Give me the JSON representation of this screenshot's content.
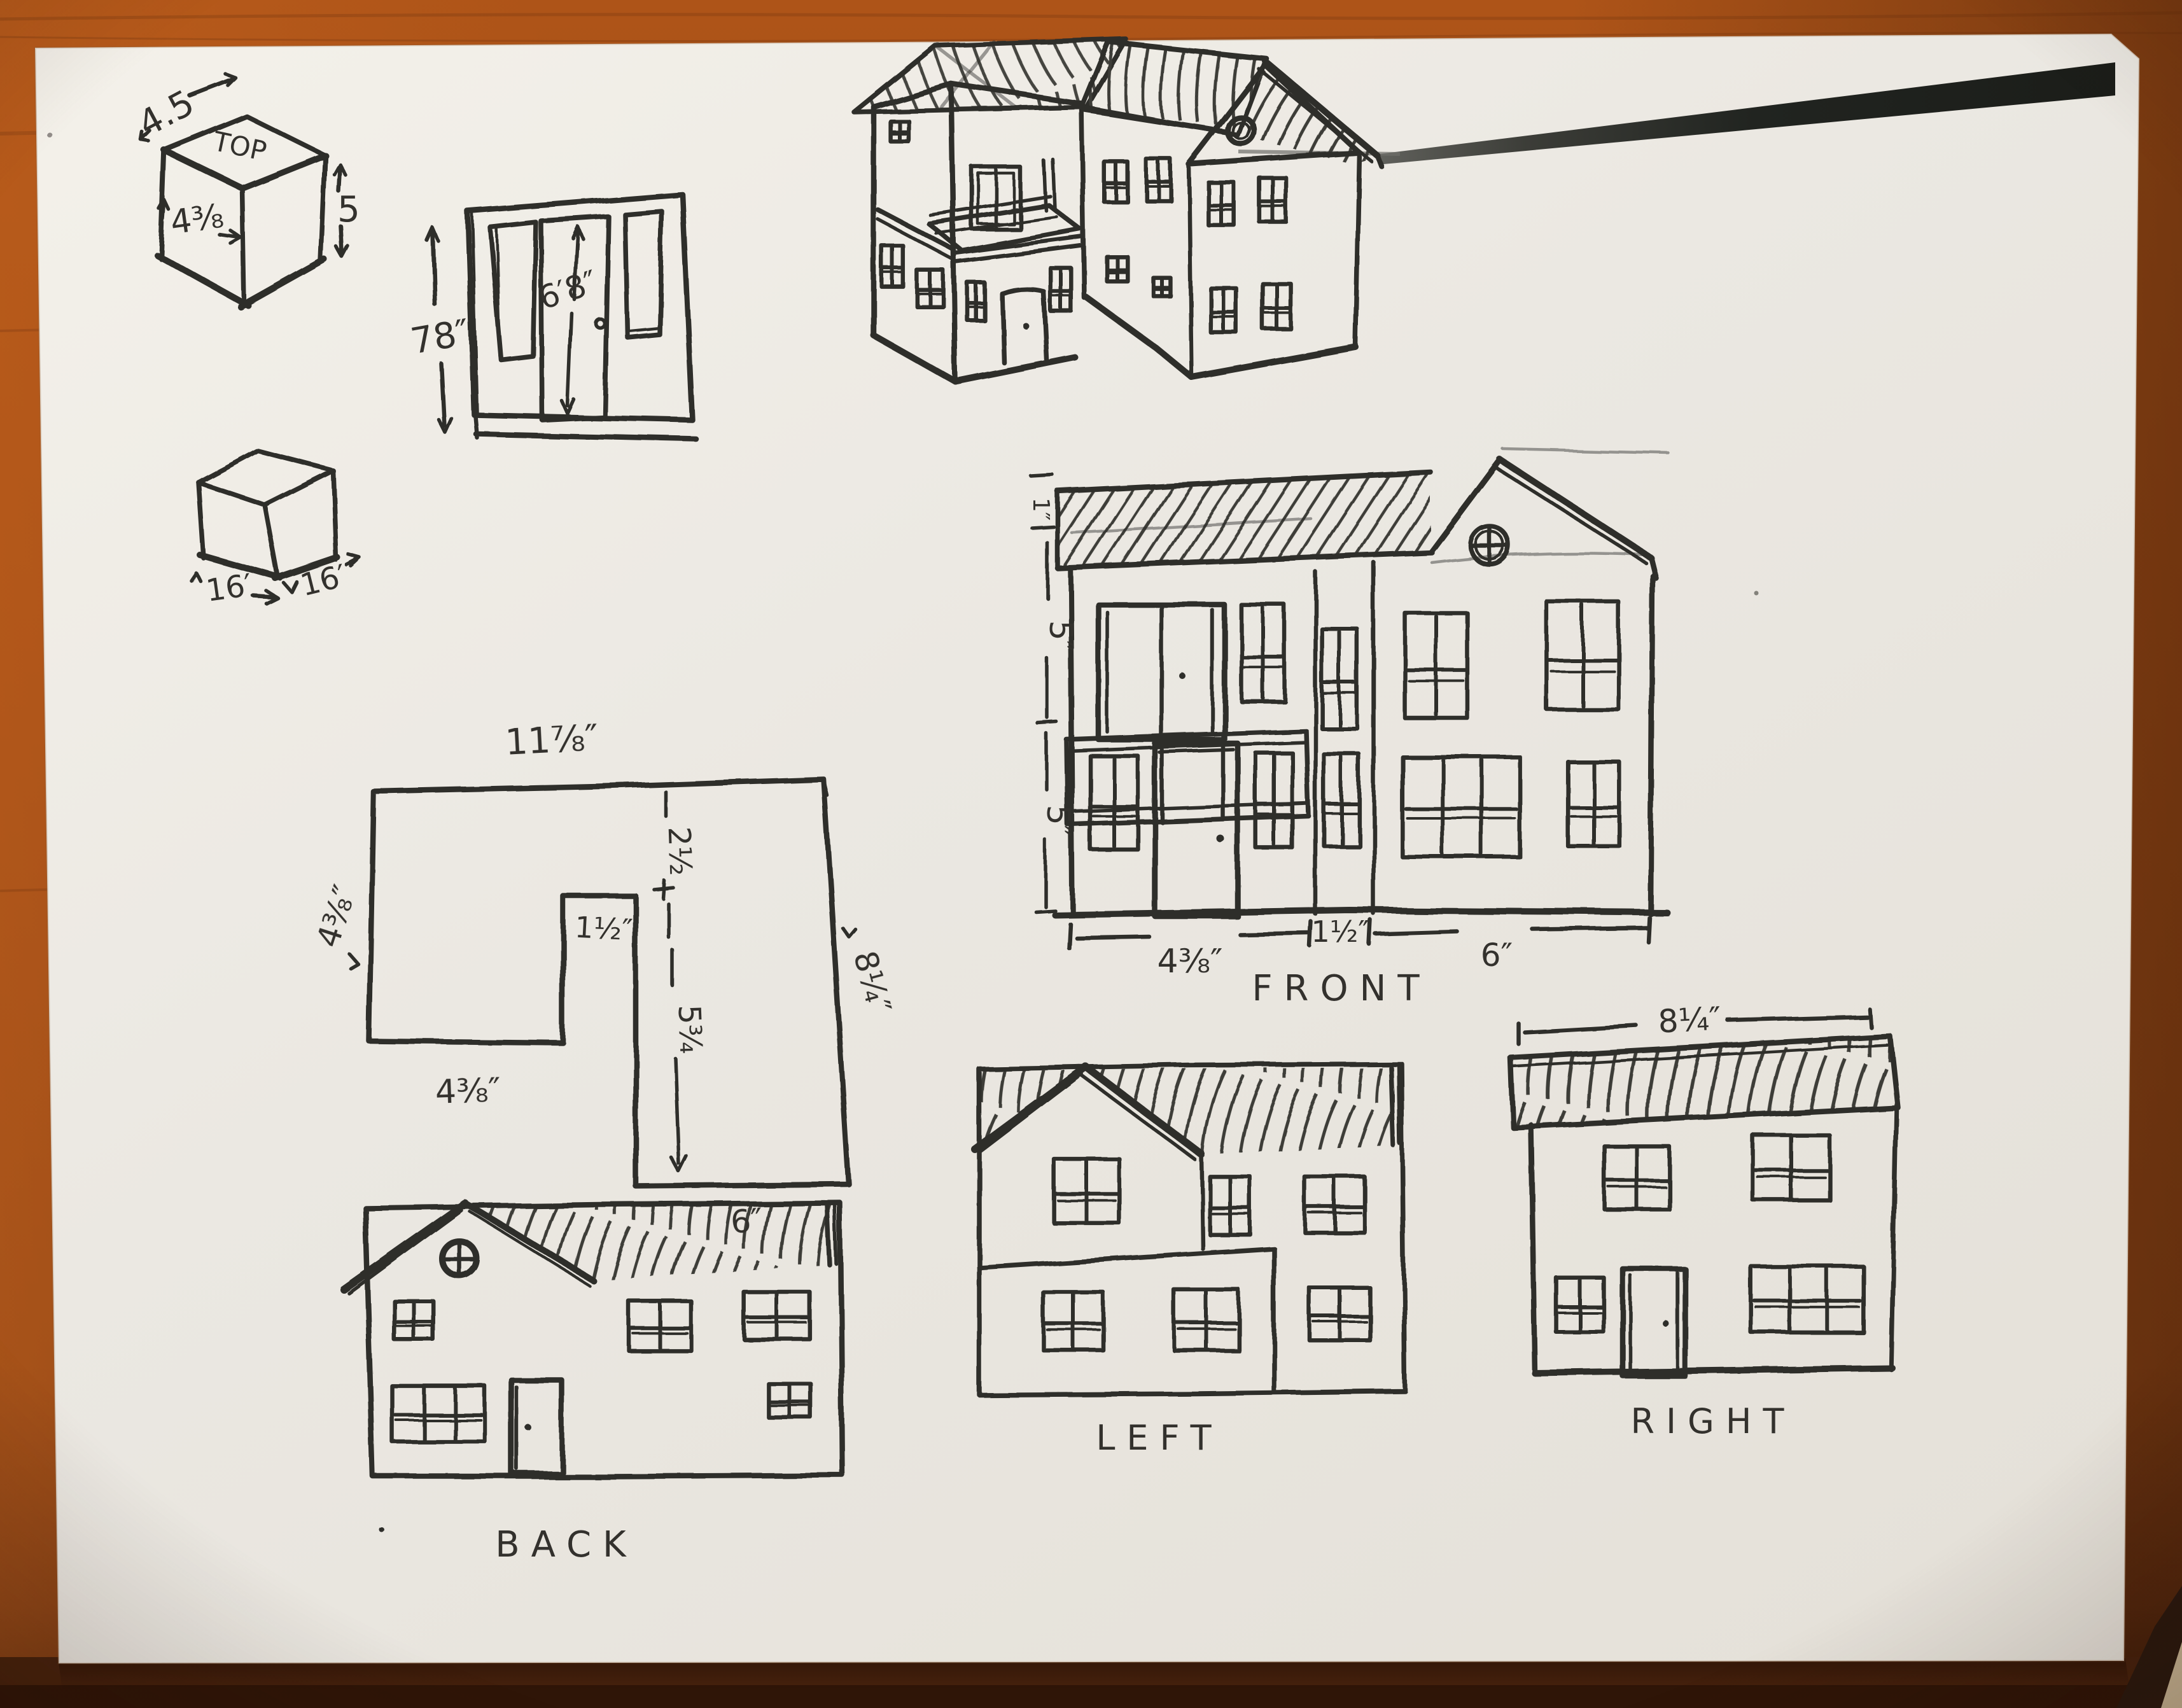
{
  "scene": {
    "type": "photograph of hand-drawn dollhouse plan sketches on paper lying on a wooden desk",
    "paper_color": "#edeae3",
    "wood_color": "#a04c17",
    "ink_color": "#2f2e2b",
    "marker_color": "#212420"
  },
  "labels": {
    "cube": {
      "top": "TOP",
      "width": "4.5",
      "face": "4⅜",
      "height": "5"
    },
    "cube_small": {
      "left": "16′",
      "right": "16′"
    },
    "door_panel": {
      "height": "78″",
      "opening": "6′8″"
    },
    "plan": {
      "top": "11⅞″",
      "left": "4⅜″",
      "notch_depth": "2½",
      "notch_width": "1½″",
      "inner_height": "5¾",
      "right": "8¼″",
      "bottom_left": "4⅜″",
      "bottom_right": "6″"
    },
    "front": {
      "title": "FRONT",
      "roof": "1″",
      "upper": "5″",
      "lower": "5″",
      "width_left": "4⅜″",
      "width_mid": "1½″",
      "width_right": "6″"
    },
    "left": {
      "title": "LEFT"
    },
    "right": {
      "title": "RIGHT",
      "width": "8¼″"
    },
    "back": {
      "title": "BACK"
    }
  }
}
